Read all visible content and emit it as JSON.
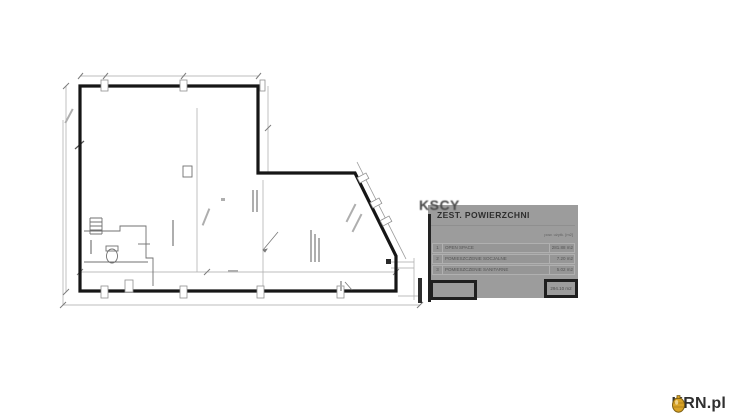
{
  "watermark": {
    "text": "KSCY"
  },
  "table": {
    "title": "ZEST. POWIERZCHNI",
    "unit_header": "pow. użytk. [m2]",
    "rows": [
      {
        "no": "1",
        "name": "OPEN SPACE",
        "area": "281.88 m2"
      },
      {
        "no": "2",
        "name": "POMIESZCZENIE SOCJALNE",
        "area": "7.20 m2"
      },
      {
        "no": "3",
        "name": "POMIESZCZENIE SANITARNE",
        "area": "5.02 m2"
      }
    ],
    "total": "294.10 m2"
  },
  "logo": {
    "brand": "KRN.pl"
  },
  "colors": {
    "wall": "#161616",
    "thin_line": "#a3a3a3",
    "panel_bg": "#9c9c9c",
    "logo_gold": "#d9a325",
    "logo_text": "#2f2f2f"
  }
}
